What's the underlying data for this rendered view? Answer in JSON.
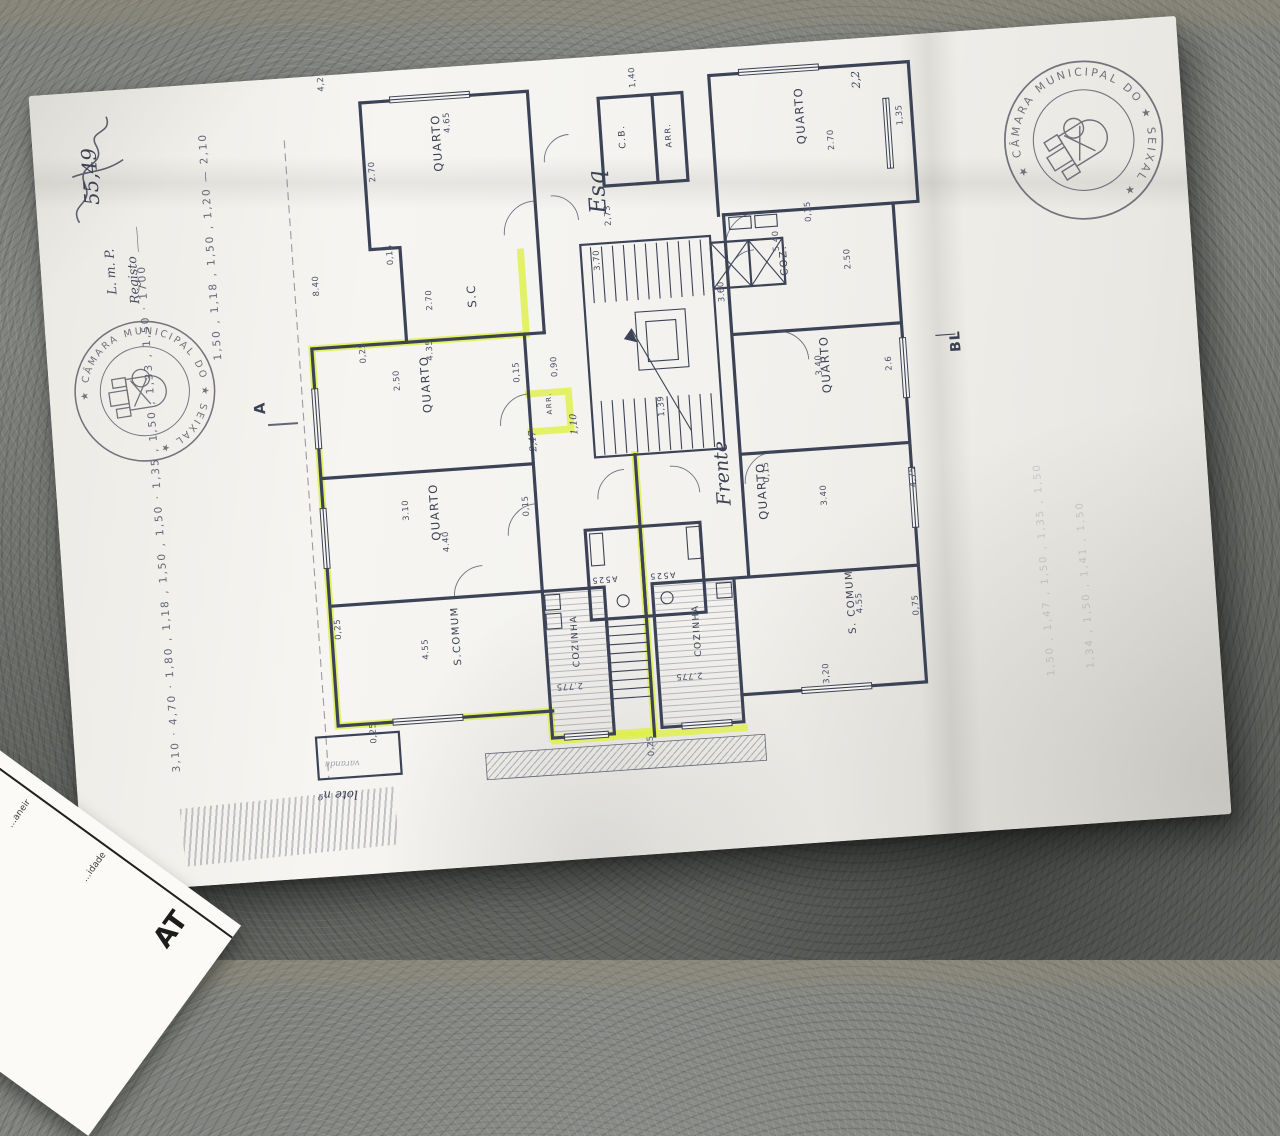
{
  "document": {
    "registry": {
      "line1": "L. m. P.",
      "line2": "Registo ____",
      "number": "55,49"
    },
    "stamp": {
      "circle_text": "★ CÂMARA MUNICIPAL DO ★ SEIXAL ★",
      "name": "Câmara Municipal do Seixal"
    },
    "margins": {
      "chain_left": "3,10 · 4,70 · 1,80 , 1,18 , 1,50 , 1,50 · 1,35 , 1,50 , 1,33 , 1,50 · 1700",
      "chain_top_left": "1,50 , 1,18 , 1,50 , 1,20 — 2,10",
      "faint_right_1": "1,50 , 1,47 , 1,50 , 1,35 , 1,50",
      "faint_right_2": "1,34 , 1,50 , 1,41 , 1,50",
      "section_marker": "A"
    }
  },
  "plan": {
    "rooms": [
      {
        "label": "QUARTO",
        "x": 168,
        "y": 102
      },
      {
        "label": "S.C",
        "x": 192,
        "y": 240
      },
      {
        "label": "C.B.",
        "x": 352,
        "y": 92,
        "size": 9
      },
      {
        "label": "ARR.",
        "x": 398,
        "y": 94,
        "size": 8
      },
      {
        "label": "QUARTO",
        "x": 532,
        "y": 100
      },
      {
        "label": "COZ.",
        "x": 505,
        "y": 230,
        "size": 10
      },
      {
        "label": "QUARTO",
        "x": 140,
        "y": 342
      },
      {
        "label": "QUARTO",
        "x": 140,
        "y": 470
      },
      {
        "label": "QUARTO",
        "x": 540,
        "y": 350
      },
      {
        "label": "QUARTO",
        "x": 468,
        "y": 472
      },
      {
        "label": "S.COMUM",
        "x": 152,
        "y": 596,
        "size": 10
      },
      {
        "label": "COZINHA",
        "x": 270,
        "y": 606,
        "size": 9
      },
      {
        "label": "COZINHA",
        "x": 392,
        "y": 604,
        "size": 9
      },
      {
        "label": "S. COMUM",
        "x": 548,
        "y": 592,
        "size": 10
      },
      {
        "label": "ARR.",
        "x": 260,
        "y": 352,
        "size": 7
      },
      {
        "label": "A525",
        "x": 314,
        "y": 518,
        "rot": 180,
        "size": 8
      },
      {
        "label": "A525",
        "x": 372,
        "y": 518,
        "rot": 180,
        "size": 8
      }
    ],
    "dims": [
      {
        "v": "4,25",
        "x": 55,
        "y": 14
      },
      {
        "v": "4.65",
        "x": 178,
        "y": 64
      },
      {
        "v": "2.70",
        "x": 100,
        "y": 108
      },
      {
        "v": "0,15",
        "x": 112,
        "y": 192
      },
      {
        "v": "2.70",
        "x": 148,
        "y": 240
      },
      {
        "v": "8.40",
        "x": 36,
        "y": 218
      },
      {
        "v": "2,73",
        "x": 332,
        "y": 168
      },
      {
        "v": "1,40",
        "x": 366,
        "y": 32
      },
      {
        "v": "2.70",
        "x": 560,
        "y": 108
      },
      {
        "v": "0,15",
        "x": 532,
        "y": 178
      },
      {
        "v": "5.40",
        "x": 498,
        "y": 205
      },
      {
        "v": "2.50",
        "x": 568,
        "y": 228
      },
      {
        "v": "3.70",
        "x": 318,
        "y": 212
      },
      {
        "v": "3.60",
        "x": 440,
        "y": 252
      },
      {
        "v": "1,39",
        "x": 372,
        "y": 362
      },
      {
        "v": "2.50",
        "x": 110,
        "y": 318
      },
      {
        "v": "4.35",
        "x": 145,
        "y": 290
      },
      {
        "v": "0,25",
        "x": 78,
        "y": 288
      },
      {
        "v": "0,15",
        "x": 230,
        "y": 318
      },
      {
        "v": "0,90",
        "x": 268,
        "y": 315
      },
      {
        "v": "3.10",
        "x": 110,
        "y": 448
      },
      {
        "v": "4.40",
        "x": 148,
        "y": 482
      },
      {
        "v": "0,15",
        "x": 230,
        "y": 452
      },
      {
        "v": "3.40",
        "x": 532,
        "y": 332
      },
      {
        "v": "2.6",
        "x": 602,
        "y": 332
      },
      {
        "v": "3.40",
        "x": 528,
        "y": 462
      },
      {
        "v": "4,75",
        "x": 618,
        "y": 450
      },
      {
        "v": "0,15",
        "x": 472,
        "y": 435
      },
      {
        "v": "4.55",
        "x": 120,
        "y": 588
      },
      {
        "v": "0,25",
        "x": 34,
        "y": 562
      },
      {
        "v": "0,25",
        "x": 62,
        "y": 668
      },
      {
        "v": "2.775",
        "x": 272,
        "y": 622,
        "rot": 180
      },
      {
        "v": "2.775",
        "x": 392,
        "y": 620,
        "rot": 180
      },
      {
        "v": "4.55",
        "x": 556,
        "y": 572
      },
      {
        "v": "3,20",
        "x": 518,
        "y": 640
      },
      {
        "v": "0,75",
        "x": 612,
        "y": 578
      },
      {
        "v": "0,25",
        "x": 338,
        "y": 700
      },
      {
        "v": "1,35",
        "x": 630,
        "y": 88
      }
    ],
    "annotations": [
      {
        "t": "Esq",
        "x": 328,
        "y": 155,
        "rot": -90,
        "size": 23,
        "cls": "hand"
      },
      {
        "t": "Frente",
        "x": 432,
        "y": 455,
        "rot": -90,
        "size": 19,
        "cls": "hand"
      },
      {
        "t": "2,2",
        "x": 590,
        "y": 48,
        "rot": -90,
        "size": 11,
        "cls": "hand"
      },
      {
        "t": "1,10",
        "x": 284,
        "y": 374,
        "rot": -90,
        "size": 9.5,
        "cls": "hand"
      },
      {
        "t": "2,47",
        "x": 242,
        "y": 388,
        "rot": -90,
        "size": 9.5,
        "cls": "hand"
      },
      {
        "t": "varanda",
        "x": 44,
        "y": 684,
        "rot": 182,
        "size": 8.5,
        "cls": "faintlbl"
      },
      {
        "t": "lote nº 16",
        "x": 40,
        "y": 714,
        "rot": 183,
        "size": 12,
        "cls": "hand"
      },
      {
        "t": "BL",
        "x": 672,
        "y": 318,
        "rot": -90,
        "size": 14,
        "cls": "planbold"
      }
    ]
  },
  "side_paper": {
    "big_label": "AT",
    "fragment1": "…idade",
    "fragment2": "…aneir"
  }
}
